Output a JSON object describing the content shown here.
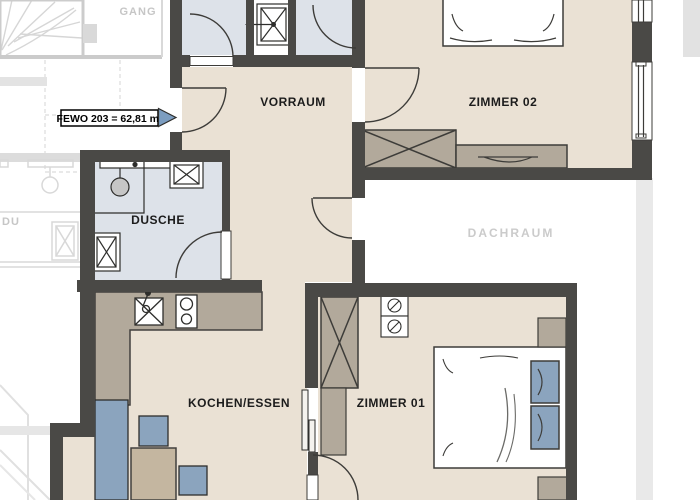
{
  "title": "Apartment floor plan FEWO 203",
  "unit_label": "FEWO 203 = 62,81 m²",
  "rooms": {
    "vorraum": "VORRAUM",
    "zimmer02": "ZIMMER 02",
    "dusche": "DUSCHE",
    "kochen_essen": "KOCHEN/ESSEN",
    "zimmer01": "ZIMMER 01"
  },
  "context": {
    "gang": "GANG",
    "du": "DU",
    "dachraum": "DACHRAUM"
  },
  "colors": {
    "wall": "#4a4946",
    "floor_living": "#eae1d4",
    "floor_wet": "#dde2e9",
    "furniture_wood": "#b2a99b",
    "furniture_blue": "#8ba4be",
    "table_wood": "#c4b6a0",
    "arrow_blue": "#7c9dc0",
    "faded_line": "#d6d6d6",
    "dachraum_strip": "#e9e9e9",
    "label_text": "#1c1c1c",
    "context_text": "#c6c6c6"
  }
}
